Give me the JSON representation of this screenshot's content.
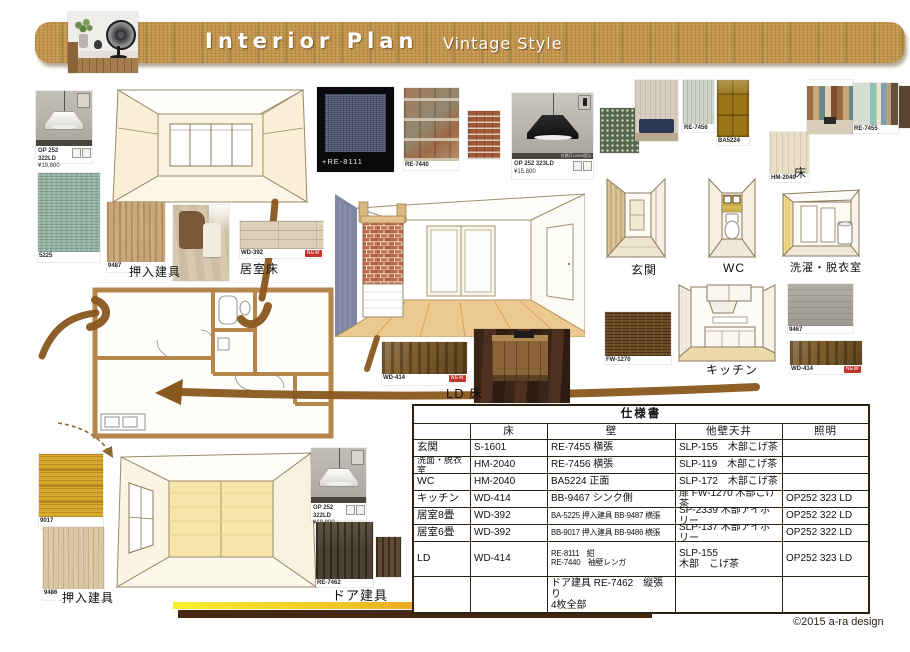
{
  "header": {
    "title": "Interior Plan",
    "subtitle": "Vintage Style"
  },
  "products": {
    "lamp_white_top": {
      "code": "OP 252 322LD",
      "price": "¥19,800"
    },
    "lamp_black": {
      "code": "OP 252 323LD",
      "price": "¥15,800",
      "strip": "白熱灯100W相当"
    },
    "lamp_white_bottom": {
      "code": "OP 252 322LD",
      "price": "¥19,800"
    },
    "swatch_5225": {
      "code": "5225"
    },
    "swatch_9487": {
      "code": "9487"
    },
    "swatch_wd392": {
      "code": "WD-392",
      "tag": "NEW"
    },
    "swatch_re8111": {
      "code": "+RE-8111"
    },
    "swatch_re7440": {
      "code": "RE-7440"
    },
    "swatch_re7456": {
      "code": "RE-7456"
    },
    "swatch_ba5224": {
      "code": "BA5224"
    },
    "swatch_hm2040": {
      "code": "HM-2040"
    },
    "swatch_re7455": {
      "code": "RE-7455"
    },
    "swatch_fw1270": {
      "code": "FW-1270"
    },
    "swatch_9467": {
      "code": "9467"
    },
    "swatch_wd414_right": {
      "code": "WD-414",
      "tag": "NEW"
    },
    "swatch_wd414_ld": {
      "code": "WD-414",
      "tag": "NEW"
    },
    "swatch_9017": {
      "code": "9017"
    },
    "swatch_9486": {
      "code": "9486"
    },
    "swatch_re7462": {
      "code": "RE-7462"
    }
  },
  "labels": {
    "oshiire_top": "押入建具",
    "kyoshitsu_yuka": "居室床",
    "genkan": "玄関",
    "wc": "WC",
    "sentaku_datsuiishitsu": "洗濯・脱衣室",
    "yuka": "床",
    "kitchen": "キッチン",
    "ld_yuka": "LD 床",
    "oshiire_bottom": "押入建具",
    "door_tategu": "ドア建具"
  },
  "spec_table": {
    "title": "仕様書",
    "columns": [
      "",
      "床",
      "壁",
      "他壁天井",
      "照明"
    ],
    "rows": [
      [
        "玄関",
        "S-1601",
        "RE-7455 横張",
        "SLP-155　木部こげ茶",
        ""
      ],
      [
        "洗面・脱衣室",
        "HM-2040",
        "RE-7456 横張",
        "SLP-119　木部こげ茶",
        ""
      ],
      [
        "WC",
        "HM-2040",
        "BA5224 正面",
        "SLP-172　木部こげ茶",
        ""
      ],
      [
        "キッチン",
        "WD-414",
        "BB-9467 シンク側",
        "扉 FW-1270 木部こげ茶",
        "OP252 323 LD"
      ],
      [
        "居室8畳",
        "WD-392",
        "BA-5225 押入建具 BB-9487 横張",
        "SP-2339 木部アイボリー",
        "OP252 322 LD"
      ],
      [
        "居室6畳",
        "WD-392",
        "BB-9017 押入建具 BB-9486 横張",
        "SLP-137 木部アイボリー",
        "OP252 322 LD"
      ],
      [
        "LD",
        "WD-414",
        "RE-8111　紺\nRE-7440　袖壁レンガ",
        "SLP-155\n木部　こげ茶",
        "OP252 323 LD"
      ],
      [
        "",
        "",
        "ドア建具 RE-7462　縦張り\n4枚全部",
        "",
        ""
      ]
    ]
  },
  "footer": {
    "copyright": "©2015 a-ra design"
  },
  "colors": {
    "accent_brown": "#8a571e",
    "banner_wood": "#c89c55",
    "bar_brown": "#46280e"
  }
}
